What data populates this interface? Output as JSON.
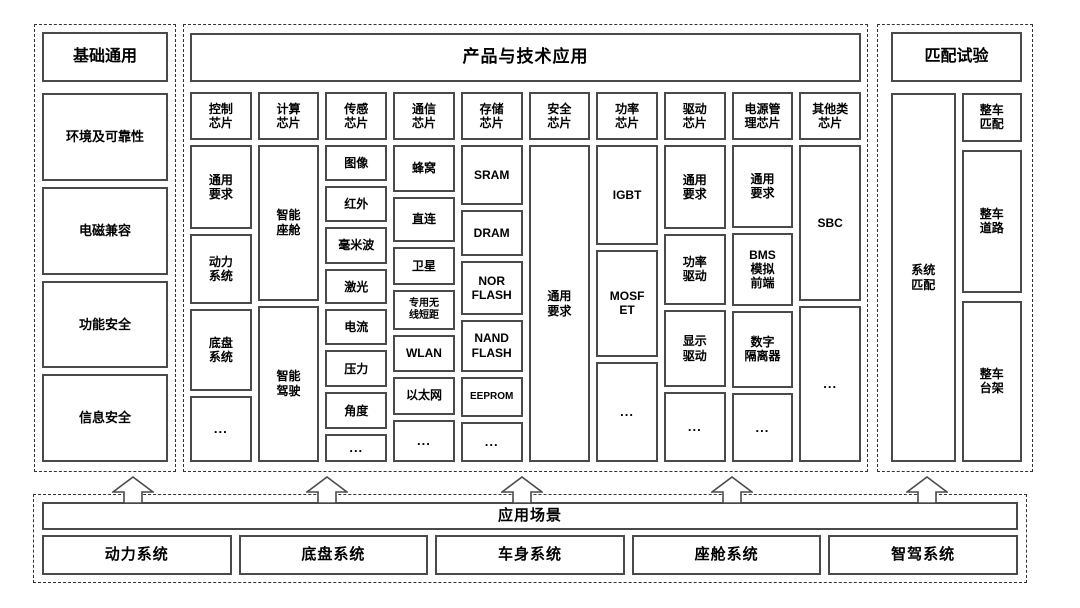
{
  "colors": {
    "line": "#4a4a4a",
    "dashed_line": "#333333",
    "background": "#ffffff",
    "text": "#000000"
  },
  "base": {
    "title": "基础通用",
    "items": [
      "环境及可靠性",
      "电磁兼容",
      "功能安全",
      "信息安全"
    ]
  },
  "products": {
    "title": "产品与技术应用",
    "columns": [
      {
        "header": "控制\n芯片",
        "items": [
          {
            "label": "通用\n要求",
            "f": 85
          },
          {
            "label": "动力\n系统",
            "f": 70
          },
          {
            "label": "底盘\n系统",
            "f": 83
          },
          {
            "label": "...",
            "f": 65
          }
        ]
      },
      {
        "header": "计算\n芯片",
        "items": [
          {
            "label": "智能\n座舱",
            "f": 156
          },
          {
            "label": "智能\n驾驶",
            "f": 157
          }
        ]
      },
      {
        "header": "传感\n芯片",
        "items": [
          {
            "label": "图像",
            "f": 36
          },
          {
            "label": "红外",
            "f": 36
          },
          {
            "label": "毫米波",
            "f": 37
          },
          {
            "label": "激光",
            "f": 35
          },
          {
            "label": "电流",
            "f": 36
          },
          {
            "label": "压力",
            "f": 37
          },
          {
            "label": "角度",
            "f": 37
          },
          {
            "label": "...",
            "f": 26
          }
        ]
      },
      {
        "header": "通信\n芯片",
        "items": [
          {
            "label": "蜂窝",
            "f": 48
          },
          {
            "label": "直连",
            "f": 47
          },
          {
            "label": "卫星",
            "f": 38
          },
          {
            "label": "专用无\n线短距",
            "f": 40,
            "small": true
          },
          {
            "label": "WLAN",
            "f": 36
          },
          {
            "label": "以太网",
            "f": 38
          },
          {
            "label": "...",
            "f": 43
          }
        ]
      },
      {
        "header": "存储\n芯片",
        "items": [
          {
            "label": "SRAM",
            "f": 62
          },
          {
            "label": "DRAM",
            "f": 46
          },
          {
            "label": "NOR\nFLASH",
            "f": 54
          },
          {
            "label": "NAND\nFLASH",
            "f": 53
          },
          {
            "label": "EEPROM",
            "f": 39,
            "small": true
          },
          {
            "label": "...",
            "f": 39
          }
        ]
      },
      {
        "header": "安全\n芯片",
        "items": [
          {
            "label": "通用\n要求",
            "f": 318
          }
        ]
      },
      {
        "header": "功率\n芯片",
        "items": [
          {
            "label": "IGBT",
            "f": 100
          },
          {
            "label": "MOSF\nET",
            "f": 106
          },
          {
            "label": "...",
            "f": 100
          }
        ]
      },
      {
        "header": "驱动\n芯片",
        "items": [
          {
            "label": "通用\n要求",
            "f": 85
          },
          {
            "label": "功率\n驱动",
            "f": 70
          },
          {
            "label": "显示\n驱动",
            "f": 78
          },
          {
            "label": "...",
            "f": 69
          }
        ]
      },
      {
        "header": "电源管\n理芯片",
        "items": [
          {
            "label": "通用\n要求",
            "f": 84
          },
          {
            "label": "BMS\n模拟\n前端",
            "f": 73
          },
          {
            "label": "数字\n隔离器",
            "f": 78
          },
          {
            "label": "...",
            "f": 69
          }
        ]
      },
      {
        "header": "其他类\n芯片",
        "items": [
          {
            "label": "SBC",
            "f": 157
          },
          {
            "label": "...",
            "f": 156
          }
        ]
      }
    ]
  },
  "matching": {
    "title": "匹配试验",
    "system_label": "系统\n匹配",
    "vehicle_items": [
      {
        "label": "整车\n匹配",
        "f": 45
      },
      {
        "label": "整车\n道路",
        "f": 140
      },
      {
        "label": "整车\n台架",
        "f": 158
      }
    ]
  },
  "scenarios": {
    "title": "应用场景",
    "items": [
      "动力系统",
      "底盘系统",
      "车身系统",
      "座舱系统",
      "智驾系统"
    ]
  }
}
